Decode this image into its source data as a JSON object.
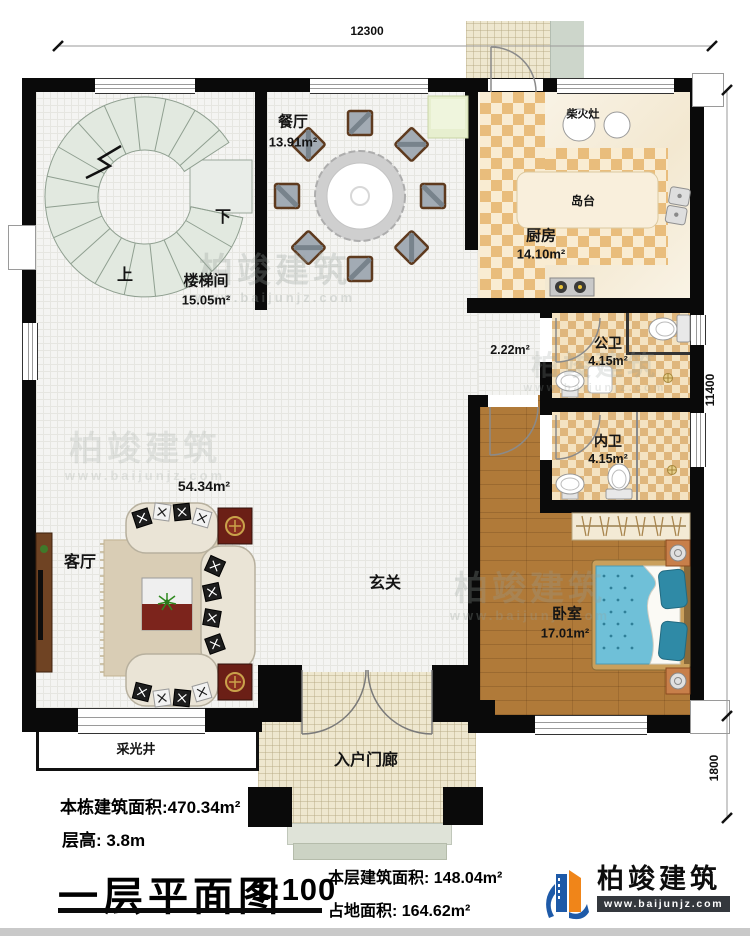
{
  "dimensions": {
    "width": "12300",
    "height_main": "11400",
    "height_porch": "1800"
  },
  "rooms": {
    "dining": {
      "label": "餐厅",
      "area": "13.91m²"
    },
    "stairwell": {
      "label": "楼梯间",
      "area": "15.05m²"
    },
    "kitchen": {
      "label": "厨房",
      "area": "14.10m²"
    },
    "public_bath": {
      "label": "公卫",
      "area": "4.15m²"
    },
    "private_bath": {
      "label": "内卫",
      "area": "4.15m²"
    },
    "bedroom": {
      "label": "卧室",
      "area": "17.01m²"
    },
    "living_room": {
      "label": "客厅",
      "area": "54.34m²"
    },
    "foyer": {
      "label": "玄关"
    },
    "corridor": {
      "area": "2.22m²"
    },
    "porch": {
      "label": "入户门廊"
    },
    "light_well": {
      "label": "采光井"
    }
  },
  "stairs": {
    "up": "上",
    "down": "下"
  },
  "kitchen_items": {
    "wood_stove": "柴火灶",
    "island": "岛台"
  },
  "footer": {
    "total_area": "本栋建筑面积:470.34m²",
    "floor_height": "层高: 3.8m",
    "title": "一层平面图",
    "scale": "1:100",
    "floor_area": "本层建筑面积: 148.04m²",
    "land_area": "占地面积: 164.62m²"
  },
  "logo": {
    "name": "柏竣建筑",
    "url": "www.baijunjz.com"
  },
  "watermark": {
    "name": "柏竣建筑",
    "url": "www.baijunjz.com"
  },
  "colors": {
    "wall": "#0a0a0a",
    "kitchen_check": "#e9bd7c",
    "wood": "#b07a39",
    "bed": "#6fc0d8",
    "logo_blue": "#1e5aa8",
    "logo_orange": "#f08519"
  }
}
